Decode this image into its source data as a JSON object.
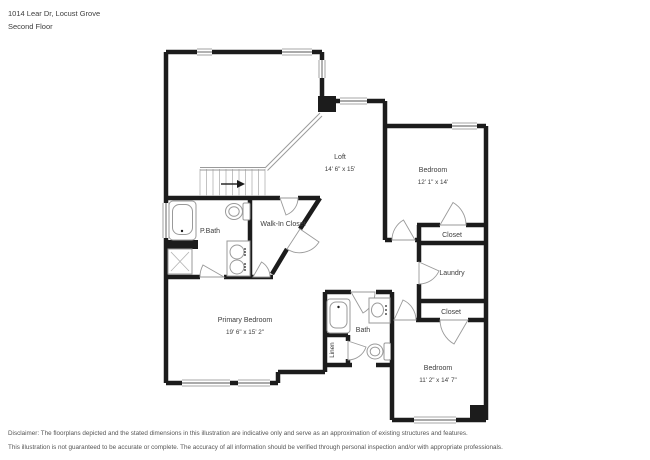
{
  "header": {
    "address": "1014 Lear Dr, Locust Grove",
    "floor_label": "Second Floor"
  },
  "plan": {
    "rooms": [
      {
        "name": "Loft",
        "dims": "14' 6\" x 15'"
      },
      {
        "name": "Bedroom",
        "dims": "12' 1\" x 14'"
      },
      {
        "name": "Closet",
        "dims": ""
      },
      {
        "name": "Laundry",
        "dims": ""
      },
      {
        "name": "Closet",
        "dims": ""
      },
      {
        "name": "Bedroom",
        "dims": "11' 2\" x 14' 7\""
      },
      {
        "name": "P.Bath",
        "dims": ""
      },
      {
        "name": "Walk-In Closet",
        "dims": ""
      },
      {
        "name": "Primary Bedroom",
        "dims": "19' 6\" x 15' 2\""
      },
      {
        "name": "Bath",
        "dims": ""
      },
      {
        "name": "Linen",
        "dims": ""
      }
    ],
    "icons": [
      "bathtub-icon",
      "shower-icon",
      "toilet-icon",
      "vanity-sink-icon",
      "sink-icon",
      "staircase-icon",
      "stair-direction-arrow-icon",
      "railing-icon",
      "door-swing-icon",
      "window-icon"
    ]
  },
  "footer": {
    "disclaimer_line1": "Disclaimer: The floorplans depicted and the stated dimensions in this illustration are indicative only and serve as an approximation of existing structures and features.",
    "disclaimer_line2": "This illustration is not guaranteed to be accurate or complete. The accuracy of all information should be verified through personal inspection and/or with appropriate professionals."
  },
  "colors": {
    "wall": "#1c1c1c",
    "fixture_stroke": "#9a9a9a",
    "text": "#3d3d3d",
    "background": "#ffffff"
  }
}
